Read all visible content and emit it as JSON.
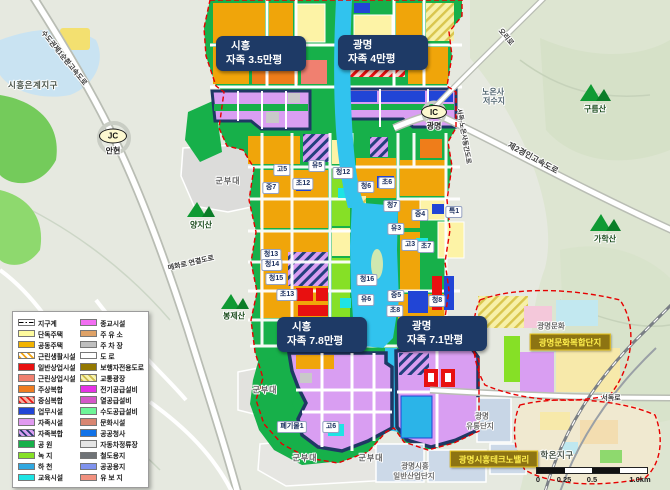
{
  "palette": {
    "apartment_gold": "#f0a50a",
    "single_house_yellow": "#fdf3a6",
    "mixed_orange": "#ef7d1a",
    "commercial_red": "#e81010",
    "business_blue": "#2145d6",
    "self_sufficiency_purple": "#d99ef2",
    "park_green": "#17b04a",
    "greenery": "#86e026",
    "river_cyan": "#31c3ee",
    "education_cyan": "#1ee4e4",
    "zone_outline_navy": "#1f3864",
    "district_dash_red": "#e60000",
    "callout_bg": "#1e3a66",
    "gold_badge_bg": "#8d7412",
    "gold_badge_text": "#ffef4d"
  },
  "legend": {
    "left": [
      {
        "label": "지구계",
        "type": "line"
      },
      {
        "label": "단독주택",
        "color": "#fdfa9e"
      },
      {
        "label": "공동주택",
        "color": "#f2b300"
      },
      {
        "label": "근린생활시설",
        "color": "#ffffff",
        "hatch": "orange"
      },
      {
        "label": "일반상업시설",
        "color": "#e81010"
      },
      {
        "label": "근린상업시설",
        "color": "#f08070"
      },
      {
        "label": "주상복합",
        "color": "#f07c20"
      },
      {
        "label": "중심복합",
        "color": "#f8b0a0",
        "hatch": "red"
      },
      {
        "label": "업무시설",
        "color": "#2145d6"
      },
      {
        "label": "자족시설",
        "color": "#e09af0"
      },
      {
        "label": "자족복합",
        "color": "#d99ef2",
        "hatch": "navy"
      },
      {
        "label": "공  원",
        "color": "#17b04a"
      },
      {
        "label": "녹  지",
        "color": "#86e026"
      },
      {
        "label": "하  천",
        "color": "#31a8e0"
      },
      {
        "label": "교육시설",
        "color": "#1ee4e4"
      }
    ],
    "right": [
      {
        "label": "종교시설",
        "color": "#f26ef2"
      },
      {
        "label": "주 유 소",
        "color": "#dfa267"
      },
      {
        "label": "주 차 장",
        "color": "#bfbfbf"
      },
      {
        "label": "도    로",
        "color": "#ffffff"
      },
      {
        "label": "보행자전용도로",
        "color": "#937800"
      },
      {
        "label": "교통광장",
        "color": "#f7f3b0",
        "hatch": "yellow"
      },
      {
        "label": "전기공급설비",
        "color": "#e533e5"
      },
      {
        "label": "열공급설비",
        "color": "#d457c8"
      },
      {
        "label": "수도공급설비",
        "color": "#6ef598"
      },
      {
        "label": "문화시설",
        "color": "#d98672"
      },
      {
        "label": "공공청사",
        "color": "#1273e8"
      },
      {
        "label": "자동차정류장",
        "color": "#e5e5e5"
      },
      {
        "label": "철도용지",
        "color": "#6f7377"
      },
      {
        "label": "공공용지",
        "color": "#8093ee"
      },
      {
        "label": "유 보 지",
        "color": "#f2917f"
      }
    ]
  },
  "callouts": [
    {
      "line1": "시흥",
      "line2": "자족 3.5만평"
    },
    {
      "line1": "광명",
      "line2": "자족 4만평"
    },
    {
      "line1": "시흥",
      "line2": "자족 7.8만평"
    },
    {
      "line1": "광명",
      "line2": "자족 7.1만평"
    }
  ],
  "zones": [
    {
      "t": "고5"
    },
    {
      "t": "유5"
    },
    {
      "t": "청12"
    },
    {
      "t": "중7"
    },
    {
      "t": "초12"
    },
    {
      "t": "청6"
    },
    {
      "t": "초6"
    },
    {
      "t": "청7"
    },
    {
      "t": "중4"
    },
    {
      "t": "특1"
    },
    {
      "t": "유3"
    },
    {
      "t": "고3"
    },
    {
      "t": "초7"
    },
    {
      "t": "청13"
    },
    {
      "t": "청14"
    },
    {
      "t": "청15"
    },
    {
      "t": "초13"
    },
    {
      "t": "청16"
    },
    {
      "t": "유6"
    },
    {
      "t": "중5"
    },
    {
      "t": "초8"
    },
    {
      "t": "청8"
    },
    {
      "t": "폐기물1"
    },
    {
      "t": "고6"
    }
  ],
  "places": [
    {
      "t": "시흥은계지구"
    },
    {
      "t": "군부대"
    },
    {
      "t": "군부대"
    },
    {
      "t": "군부대"
    },
    {
      "t": "군부대"
    },
    {
      "t": "노온사"
    },
    {
      "t": "저수지"
    },
    {
      "t": "광명문화"
    },
    {
      "t": "광명"
    },
    {
      "t": "유통단지"
    },
    {
      "t": "광명시흥"
    },
    {
      "t": "일반산업단지"
    },
    {
      "t": "학온지구"
    }
  ],
  "mountains": [
    {
      "name": "양지산"
    },
    {
      "name": "봉제산"
    },
    {
      "name": "구름산"
    },
    {
      "name": "가학산"
    }
  ],
  "roads": [
    {
      "t": "수도권제1순환고속도로"
    },
    {
      "t": "오리로"
    },
    {
      "t": "제2경인고속도로"
    },
    {
      "t": "서독-노온사동간도로"
    },
    {
      "t": "매화로 연결도로"
    },
    {
      "t": "서독로"
    }
  ],
  "junctions": [
    {
      "code": "JC",
      "name": "안현"
    },
    {
      "code": "IC",
      "name": "광명"
    }
  ],
  "gold_badges": [
    {
      "label": "광명문화복합단지"
    },
    {
      "label": "광명시흥테크노밸리"
    }
  ],
  "scalebar": {
    "labels": [
      "0",
      "0.25",
      "0.5",
      "1.0km"
    ]
  }
}
